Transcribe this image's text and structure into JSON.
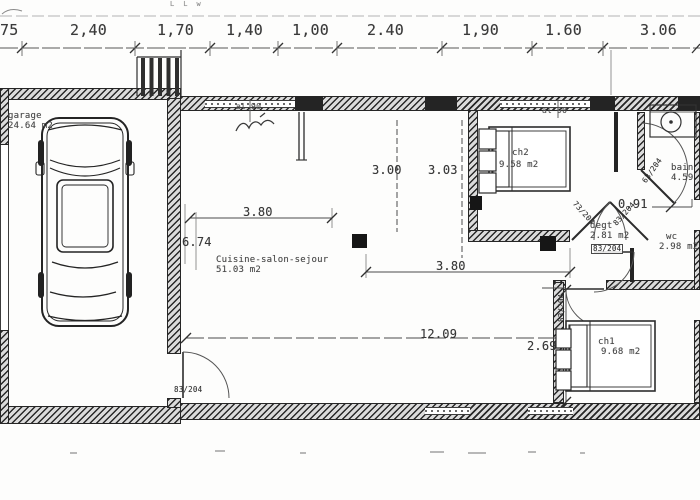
{
  "colors": {
    "ink": "#323232",
    "paper": "#ffffff",
    "wall_fill": "#dcdcdc"
  },
  "top_dims": [
    "75",
    "2,40",
    "1,70",
    "1,40",
    "1,00",
    "2.40",
    "1,90",
    "1.60",
    "3.06"
  ],
  "inner_dims": {
    "h_living_a": "3.00",
    "h_living_b": "3.03",
    "w_kitchen": "3.80",
    "h_total": "6.74",
    "w_living": "3.80",
    "w_total": "12.09",
    "h_ch1": "2.69",
    "w_hall": "0.91"
  },
  "rooms": {
    "garage": {
      "name": "garage",
      "area": "24.64 m2"
    },
    "living": {
      "name": "Cuisine-salon-sejour",
      "area": "51.03 m2"
    },
    "ch2": {
      "name": "ch2",
      "area": "9.58 m2"
    },
    "bain": {
      "name": "bain",
      "area": "4.59 m2"
    },
    "degt": {
      "name": "degt",
      "area": "2.81 m2"
    },
    "wc": {
      "name": "wc",
      "area": "2.98 m2"
    },
    "ch1": {
      "name": "ch1",
      "area": "9.68 m2"
    }
  },
  "doors": {
    "living": "83/204",
    "hall_left": "73/204",
    "hall_right": "83/204",
    "bain": "63/204",
    "wc": "83/204",
    "ch1": "83/204"
  },
  "annotations": {
    "sill_left": "al 90",
    "sill_right": "al 90",
    "top_marks": "L  L  w"
  }
}
